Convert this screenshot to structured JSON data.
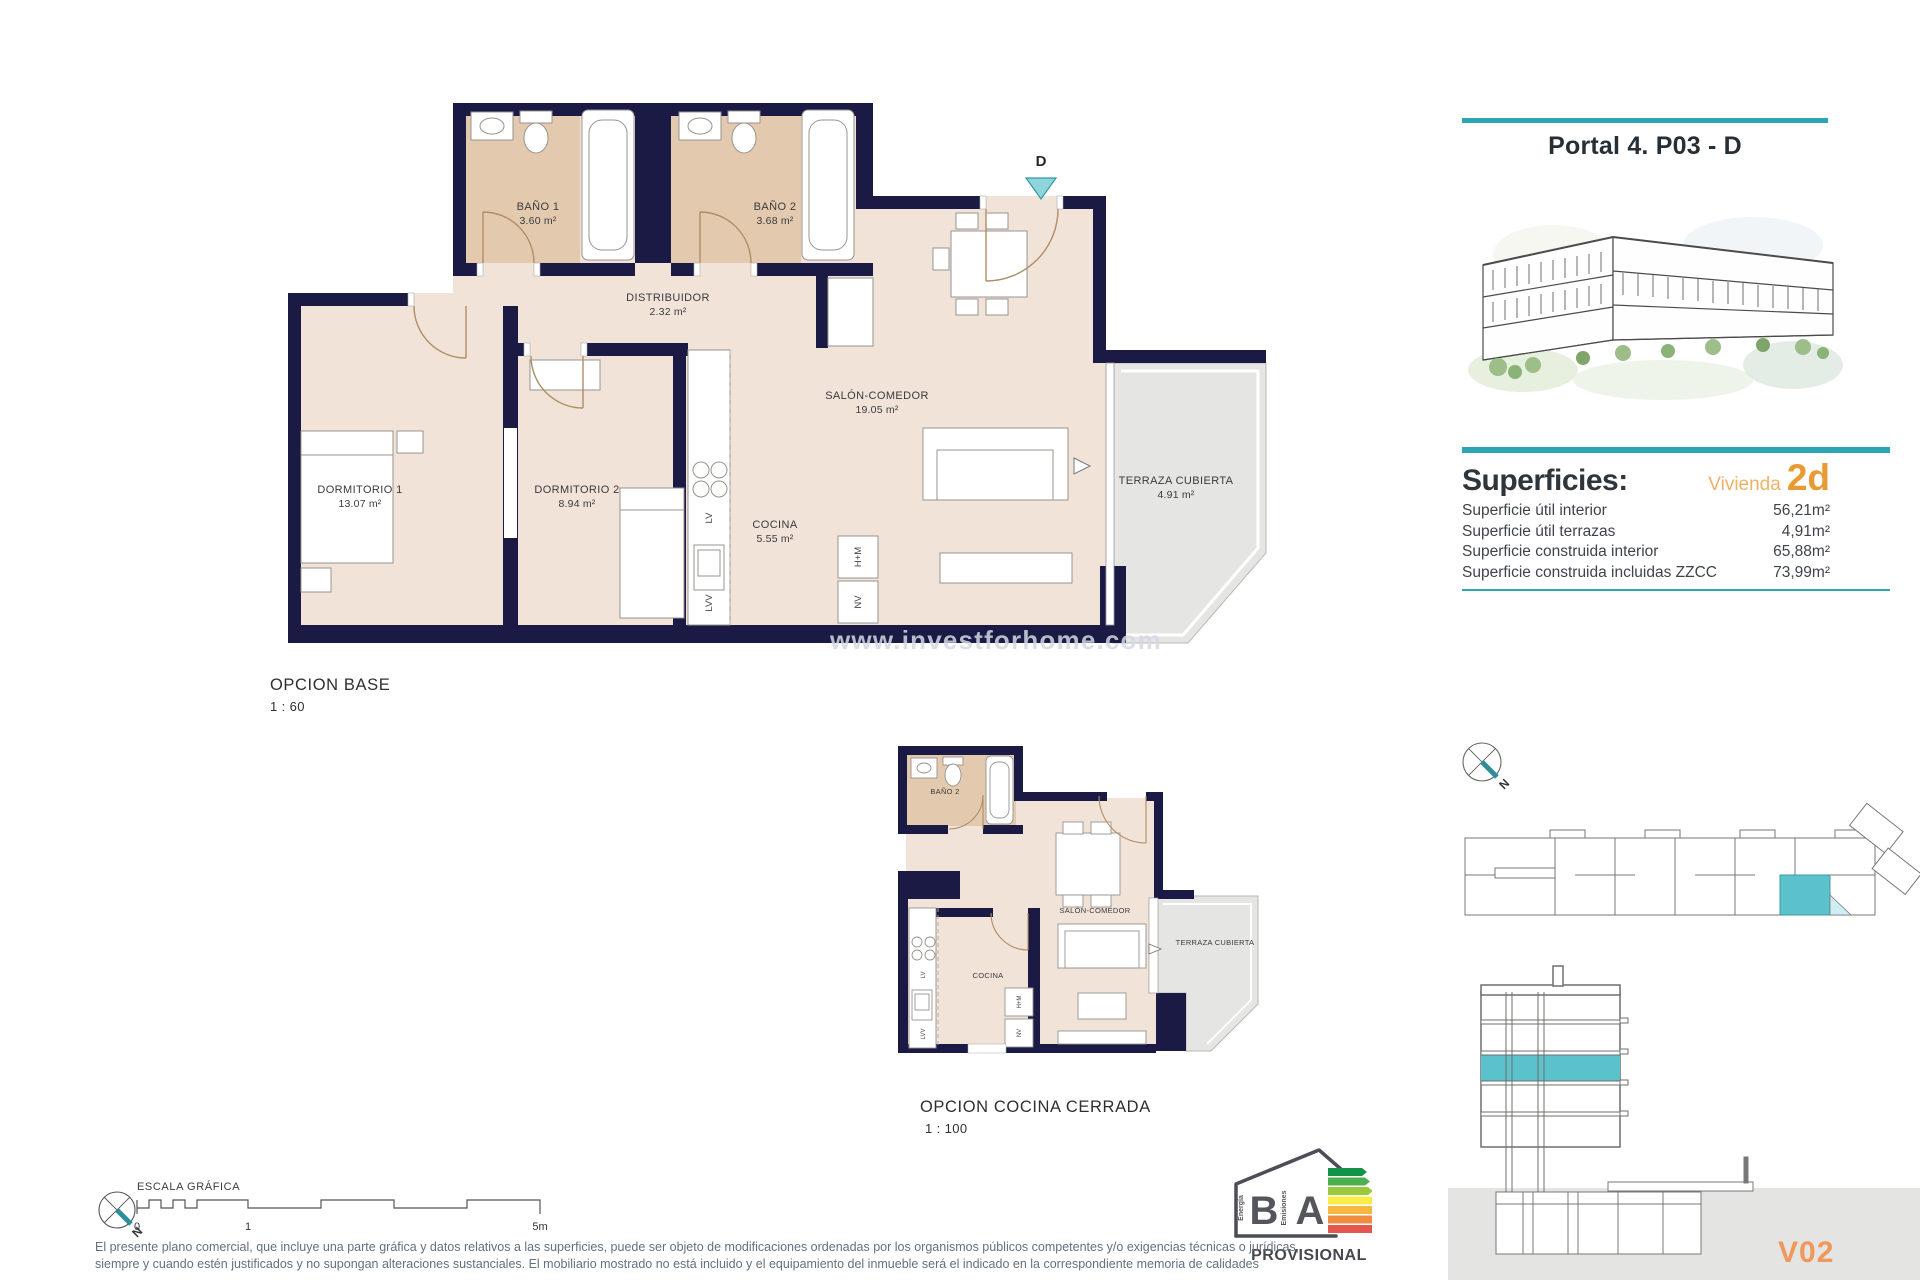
{
  "colors": {
    "teal": "#2CA6B2",
    "teal_light": "#8FD4DA",
    "orange": "#E89B33",
    "orange_light": "#EDB266",
    "wall_navy": "#1A1A44",
    "floor_beige": "#F1E3D8",
    "floor_tan": "#E3CAAF",
    "terrace_gray": "#E5E5E3"
  },
  "header": {
    "title": "Portal 4. P03 - D"
  },
  "superficies": {
    "title": "Superficies:",
    "vivienda_label": "Vivienda",
    "vivienda_code": "2d",
    "rows": [
      {
        "label": "Superficie útil interior",
        "value": "56,21m²"
      },
      {
        "label": "Superficie útil terrazas",
        "value": "4,91m²"
      },
      {
        "label": "Superficie construida interior",
        "value": "65,88m²"
      },
      {
        "label": "Superficie construida incluidas ZZCC",
        "value": "73,99m²"
      }
    ]
  },
  "main_plan": {
    "caption": "OPCION BASE",
    "scale": "1 : 60",
    "entry_letter": "D",
    "watermark": "www.investforhome.com",
    "rooms": {
      "bano1": {
        "name": "BAÑO 1",
        "area": "3.60 m²"
      },
      "bano2": {
        "name": "BAÑO 2",
        "area": "3.68 m²"
      },
      "distribuidor": {
        "name": "DISTRIBUIDOR",
        "area": "2.32 m²"
      },
      "salon": {
        "name": "SALÓN-COMEDOR",
        "area": "19.05 m²"
      },
      "dormitorio1": {
        "name": "DORMITORIO 1",
        "area": "13.07 m²"
      },
      "dormitorio2": {
        "name": "DORMITORIO 2",
        "area": "8.94 m²"
      },
      "cocina": {
        "name": "COCINA",
        "area": "5.55 m²"
      },
      "terraza": {
        "name": "TERRAZA CUBIERTA",
        "area": "4.91 m²"
      }
    },
    "appliances": {
      "lv": "LV",
      "lvv": "LVV",
      "hm": "H+M",
      "nv": "NV"
    }
  },
  "small_plan": {
    "caption": "OPCION COCINA CERRADA",
    "scale": "1 : 100",
    "rooms": {
      "bano2": "BAÑO 2",
      "salon": "SALÓN-COMEDOR",
      "cocina": "COCINA",
      "terraza": "TERRAZA CUBIERTA"
    },
    "appliances": {
      "lv": "LV",
      "lvv": "LVV",
      "hm": "H+M",
      "nv": "NV"
    }
  },
  "scale_bar": {
    "title": "ESCALA GRÁFICA",
    "tick0": "0",
    "tick1": "1",
    "tick5": "5m"
  },
  "compass": {
    "north": "N"
  },
  "energy": {
    "letter_energy": "B",
    "letter_emissions": "A",
    "label_energy": "Energía",
    "label_emissions": "Emisiones",
    "status": "PROVISIONAL"
  },
  "drawing_code": "V02",
  "disclaimer": {
    "line1": "El presente plano comercial, que incluye una parte gráfica y datos relativos a las superficies, puede ser objeto de modificaciones ordenadas por los organismos públicos competentes y/o exigencias técnicas o jurídicas,",
    "line2": "siempre y cuando estén justificados y no supongan alteraciones sustanciales. El mobiliario mostrado no está incluido y el equipamiento del inmueble será el indicado en la correspondiente memoria de calidades"
  }
}
